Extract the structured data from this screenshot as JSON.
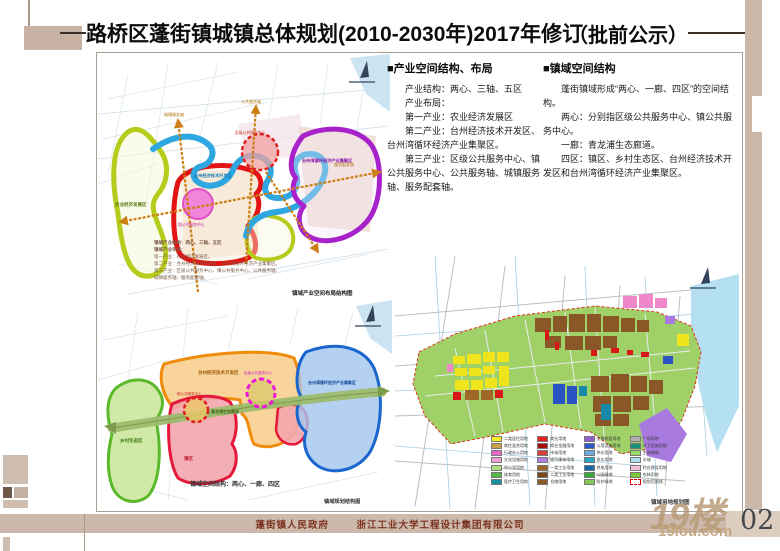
{
  "page": {
    "title": "路桥区蓬街镇城镇总体规划(2010-2030年)2017年修订",
    "notice": "（批前公示）",
    "bullet": "■",
    "page_number": "02",
    "footer_left": "蓬街镇人民政府",
    "footer_right": "浙江工业大学工程设计集团有限公司",
    "watermark_text": "19楼",
    "watermark_site": "19lou.com",
    "colors": {
      "accent_tan": "#c8b2a3",
      "footer_red": "#7c3222",
      "band_tan": "#ccb9ab"
    }
  },
  "sections": [
    {
      "heading": "产业空间结构、布局",
      "lines": [
        "产业结构：两心、三轴、五区",
        "产业布局：",
        "第一产业：农业经济发展区",
        "第二产业：台州经济技术开发区、台州湾循环经济产业集聚区。",
        "第三产业：区级公共服务中心、镇公共服务中心、公共服务轴、城镇服务轴、服务配套轴。"
      ]
    },
    {
      "heading": "镇域空间结构",
      "lines": [
        "蓬街镇域形成“两心、一廊、四区”的空间结构。",
        "两心：分别指区级公共服务中心、镇公共服务中心。",
        "一廊：青龙浦生态廊道。",
        "四区：镇区、乡村生态区、台州经济技术开发区和台州湾循环经济产业集聚区。"
      ]
    }
  ],
  "maps": {
    "industry": {
      "caption": "镇域产业空间布局结构图",
      "notes": [
        "镇域产业结构：两心、三轴、五区",
        "镇域产业布局：",
        "第一产业：农业经济发展区。",
        "第二产业：台州经济技术开发区、台州湾循环经济产业集聚区。",
        "第三产业：区级公共服务中心、镇公共服务中心、公共服务轴、",
        "城镇服务轴、服务配套轴。"
      ],
      "labels": {
        "agri": "农业经济发展区",
        "town_center": "镇公共服务中心",
        "district_center": "区级公共服务中心",
        "tech": "台州经济技术开发区",
        "circular": "台州湾循环经济产业集聚区"
      },
      "axis_labels": [
        "公共服务轴",
        "城镇服务轴",
        "服务配套轴"
      ]
    },
    "structure": {
      "caption": "镇域规划结构图",
      "inner_caption": "镇域空间结构：两心、一廊、四区",
      "labels": {
        "rural": "乡村生态区",
        "town": "镇区",
        "tech": "台州经济技术开发区",
        "circular": "台州湾循环经济产业集聚区",
        "corridor": "青龙浦生态廊道",
        "town_center": "镇公共服务中心",
        "district_center": "区级公共服务中心"
      }
    },
    "landuse": {
      "caption": "镇域用地规划图",
      "legend": [
        {
          "color": "#f7ef25",
          "label": "二类居住用地"
        },
        {
          "color": "#c8a050",
          "label": "商住混合用地"
        },
        {
          "color": "#e868c8",
          "label": "行政办公用地"
        },
        {
          "color": "#f0a0d0",
          "label": "文化设施用地"
        },
        {
          "color": "#b0e080",
          "label": "中小学用地"
        },
        {
          "color": "#50b840",
          "label": "体育用地"
        },
        {
          "color": "#1890a0",
          "label": "医疗卫生用地"
        },
        {
          "color": "#e82020",
          "label": "商业用地"
        },
        {
          "color": "#a81010",
          "label": "商业金融用地"
        },
        {
          "color": "#d84040",
          "label": "市场用地"
        },
        {
          "color": "#b080e0",
          "label": "娱乐康体用地"
        },
        {
          "color": "#a06828",
          "label": "一类工业用地"
        },
        {
          "color": "#784818",
          "label": "二类工业用地"
        },
        {
          "color": "#8a5a28",
          "label": "仓储用地"
        },
        {
          "color": "#9060d0",
          "label": "交通枢纽用地"
        },
        {
          "color": "#2858c8",
          "label": "公用设施用地"
        },
        {
          "color": "#70a8e0",
          "label": "供水用地"
        },
        {
          "color": "#28a8c8",
          "label": "排水用地"
        },
        {
          "color": "#1868a8",
          "label": "供电用地"
        },
        {
          "color": "#38a838",
          "label": "公园绿地"
        },
        {
          "color": "#88c858",
          "label": "防护绿地"
        },
        {
          "color": "#b0b0b0",
          "label": "广场用地"
        },
        {
          "color": "#189078",
          "label": "环卫设施用地"
        },
        {
          "color": "#98d868",
          "label": "生态绿地"
        },
        {
          "color": "#aaddee",
          "label": "水域"
        },
        {
          "color": "#f0c0d8",
          "label": "村庄建设用地"
        },
        {
          "color": "#78c838",
          "label": "农林用地"
        },
        {
          "color": "#ffffff",
          "label": "规划范围线",
          "dashed": true
        }
      ]
    }
  }
}
